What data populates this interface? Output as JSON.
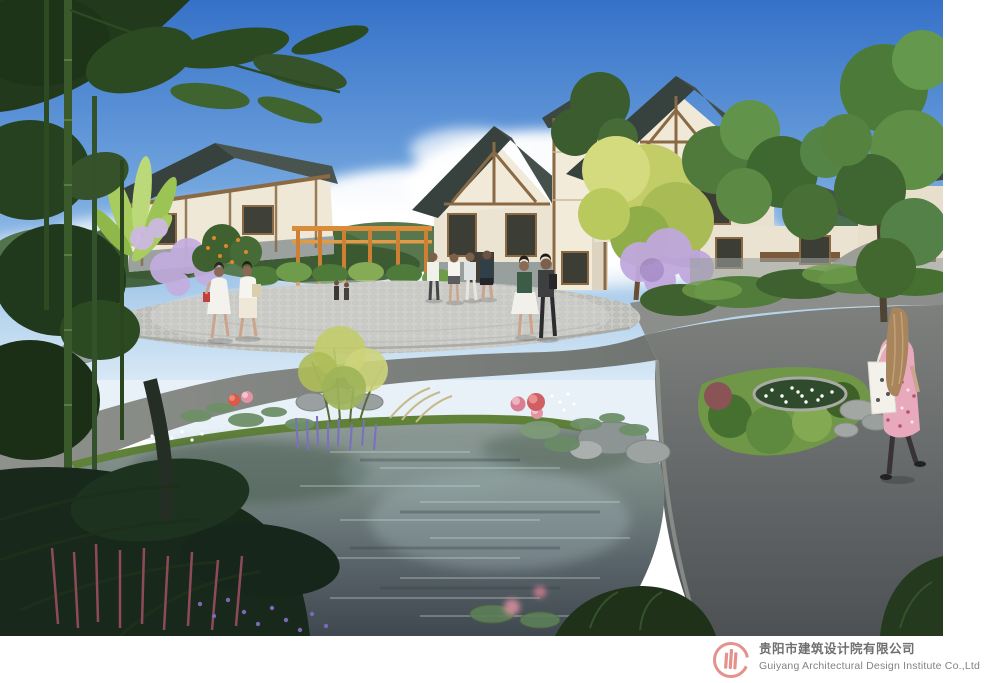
{
  "footer": {
    "company_zh": "贵阳市建筑设计院有限公司",
    "company_en": "Guiyang Architectural Design Institute Co.,Ltd",
    "logo": {
      "icon": "building-bars-in-circle-icon",
      "color": "#e5928c"
    }
  },
  "palette": {
    "sky_top": "#3571c8",
    "sky_horizon": "#d9e9f6",
    "cloud": "#ffffff",
    "roof_dark": "#3a453f",
    "roof_light": "#4b5651",
    "wall_cream": "#f1ead8",
    "timber_brown": "#8a6a45",
    "pergola_orange": "#d3863a",
    "plaza_paving": "#c7c8c4",
    "road_asphalt": "#6f7370",
    "road_dark": "#4e5254",
    "water_light": "#97a29e",
    "water_dark": "#434c52",
    "foliage_dark": "#2c4a22",
    "foliage_mid": "#4e7a3a",
    "foliage_light": "#a9cc5e",
    "blossom_purple": "#c0a8dd",
    "lotus_pink": "#e493a5",
    "flower_lavender": "#7a6fc0",
    "bamboo_green": "#3a5a2c"
  },
  "scene": {
    "elements": [
      "sky",
      "clouds",
      "background-trees",
      "chinese-style-houses",
      "pergola",
      "cobblestone-plaza",
      "asphalt-roads",
      "lotus-pond",
      "lotus-flowers",
      "rock-edges",
      "lavender-flowers",
      "daisy-patch",
      "bamboo-grove",
      "pedestrians",
      "walking-woman",
      "banana-plant",
      "purple-blossom-trees"
    ]
  }
}
